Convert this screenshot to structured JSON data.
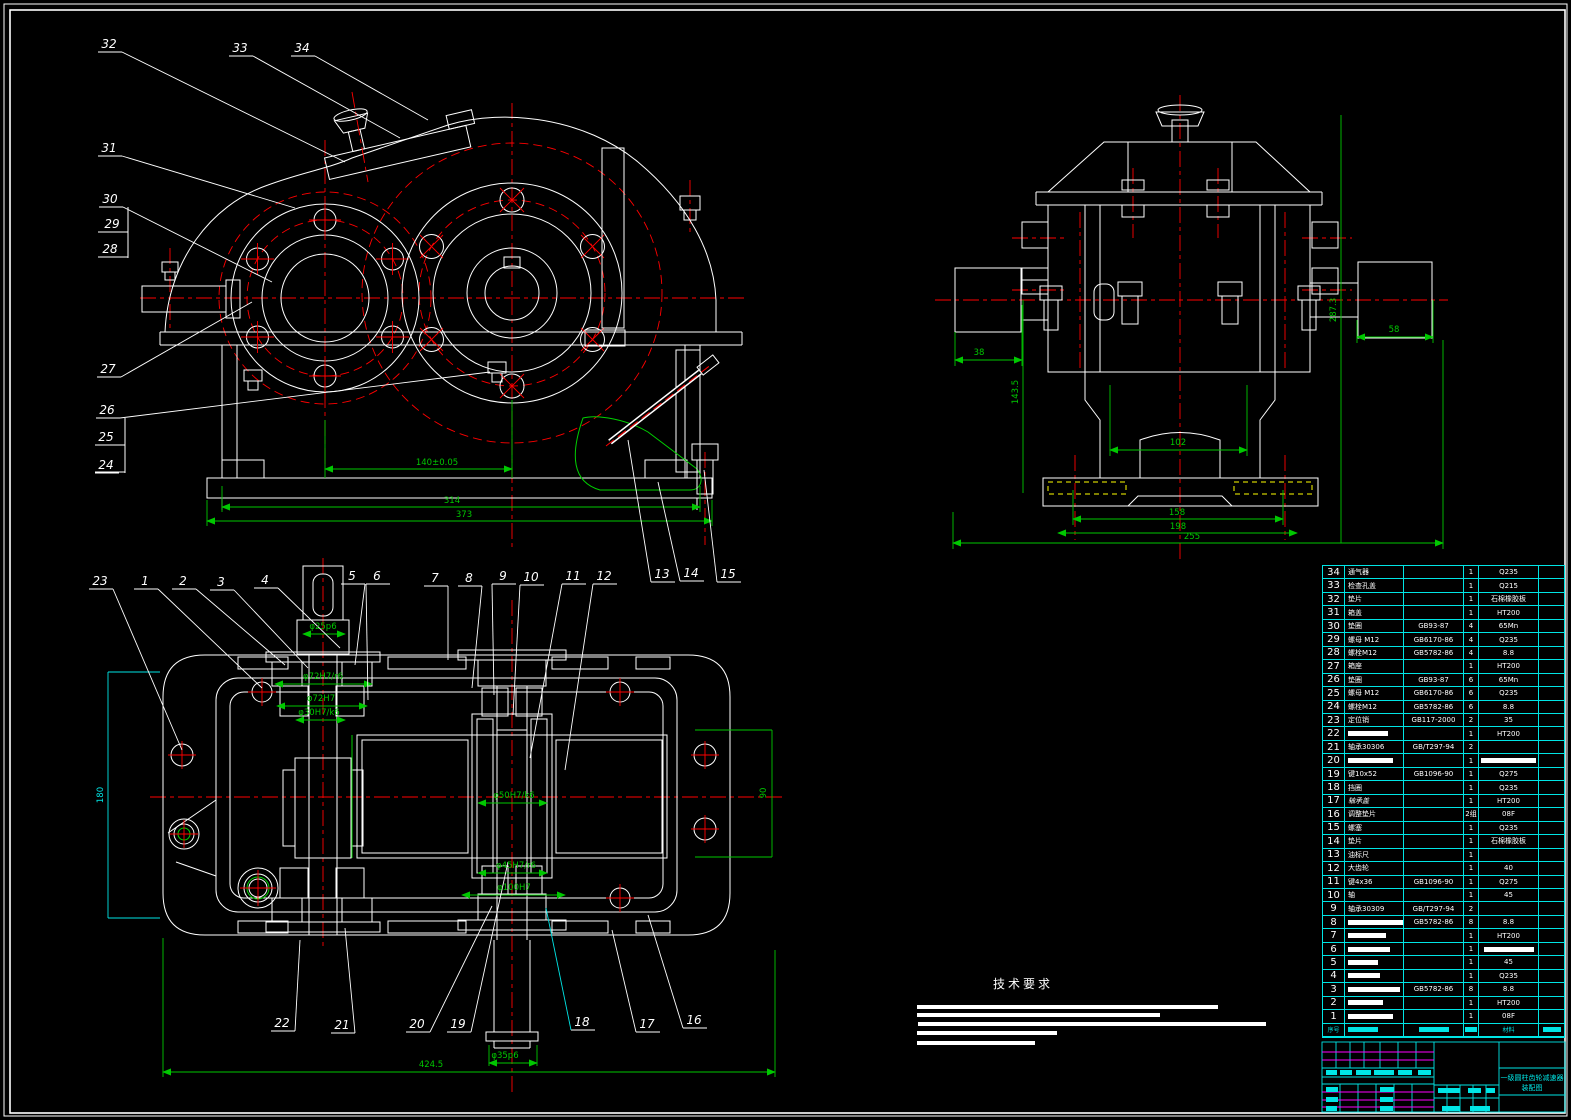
{
  "sheet": {
    "bg": "#000000",
    "line_white": "#ffffff",
    "line_red": "#ff0000",
    "line_green": "#00c800",
    "line_cyan": "#00e5e5",
    "line_yellow": "#ffff00",
    "line_magenta": "#ff00ff"
  },
  "tech_req": {
    "heading": "技术要求",
    "bars": [
      [
        917,
        1005,
        301
      ],
      [
        917,
        1013,
        243
      ],
      [
        918,
        1022,
        348
      ],
      [
        917,
        1031,
        140
      ],
      [
        917,
        1041,
        118
      ]
    ]
  },
  "title_block": {
    "title_line1": "一级圆柱齿轮减速器",
    "title_line2": "装配图",
    "bars": [
      [
        1326,
        1070,
        11
      ],
      [
        1340,
        1070,
        12
      ],
      [
        1356,
        1070,
        15
      ],
      [
        1374,
        1070,
        20
      ],
      [
        1398,
        1070,
        14
      ],
      [
        1418,
        1070,
        13
      ],
      [
        1326,
        1087,
        12
      ],
      [
        1326,
        1097,
        12
      ],
      [
        1326,
        1106,
        11
      ],
      [
        1380,
        1087,
        14
      ],
      [
        1380,
        1097,
        13
      ],
      [
        1380,
        1106,
        13
      ],
      [
        1438,
        1088,
        22
      ],
      [
        1468,
        1088,
        13
      ],
      [
        1486,
        1088,
        9
      ],
      [
        1442,
        1106,
        18
      ],
      [
        1470,
        1106,
        20
      ]
    ]
  },
  "balloons": [
    {
      "n": "32",
      "x": 107,
      "y": 48,
      "tx": 345,
      "ty": 162
    },
    {
      "n": "33",
      "x": 238,
      "y": 52,
      "tx": 400,
      "ty": 138
    },
    {
      "n": "34",
      "x": 300,
      "y": 52,
      "tx": 428,
      "ty": 120
    },
    {
      "n": "31",
      "x": 107,
      "y": 152,
      "tx": 295,
      "ty": 208
    },
    {
      "n": "30",
      "x": 108,
      "y": 203,
      "tx": 272,
      "ty": 282
    },
    {
      "n": "29",
      "x": 110,
      "y": 228
    },
    {
      "n": "28",
      "x": 108,
      "y": 253
    },
    {
      "n": "27",
      "x": 106,
      "y": 373,
      "tx": 252,
      "ty": 302
    },
    {
      "n": "26",
      "x": 105,
      "y": 414,
      "tx": 490,
      "ty": 372
    },
    {
      "n": "25",
      "x": 104,
      "y": 441
    },
    {
      "n": "24",
      "x": 104,
      "y": 469
    },
    {
      "n": "13",
      "x": 660,
      "y": 578,
      "tx": 628,
      "ty": 440
    },
    {
      "n": "14",
      "x": 689,
      "y": 577,
      "tx": 658,
      "ty": 482
    },
    {
      "n": "15",
      "x": 726,
      "y": 578,
      "tx": 704,
      "ty": 470
    },
    {
      "n": "23",
      "x": 98,
      "y": 585,
      "tx": 182,
      "ty": 750
    },
    {
      "n": "1",
      "x": 143,
      "y": 585,
      "tx": 262,
      "ty": 688
    },
    {
      "n": "2",
      "x": 181,
      "y": 585,
      "tx": 285,
      "ty": 665
    },
    {
      "n": "3",
      "x": 219,
      "y": 586,
      "tx": 308,
      "ty": 668
    },
    {
      "n": "4",
      "x": 263,
      "y": 584,
      "tx": 340,
      "ty": 648
    },
    {
      "n": "5",
      "x": 350,
      "y": 580,
      "tx": 355,
      "ty": 665
    },
    {
      "n": "6",
      "x": 375,
      "y": 580,
      "tx": 368,
      "ty": 700
    },
    {
      "n": "7",
      "x": 433,
      "y": 582,
      "tx": 448,
      "ty": 660
    },
    {
      "n": "8",
      "x": 467,
      "y": 582,
      "tx": 472,
      "ty": 688
    },
    {
      "n": "9",
      "x": 501,
      "y": 580,
      "tx": 494,
      "ty": 695
    },
    {
      "n": "10",
      "x": 529,
      "y": 581,
      "tx": 513,
      "ty": 715
    },
    {
      "n": "11",
      "x": 571,
      "y": 580,
      "tx": 530,
      "ty": 758
    },
    {
      "n": "12",
      "x": 602,
      "y": 580,
      "tx": 565,
      "ty": 770
    },
    {
      "n": "22",
      "x": 280,
      "y": 1027,
      "tx": 300,
      "ty": 940
    },
    {
      "n": "21",
      "x": 340,
      "y": 1029,
      "tx": 345,
      "ty": 928
    },
    {
      "n": "20",
      "x": 415,
      "y": 1028,
      "tx": 492,
      "ty": 906
    },
    {
      "n": "19",
      "x": 456,
      "y": 1028,
      "tx": 508,
      "ty": 862
    },
    {
      "n": "18",
      "x": 580,
      "y": 1026,
      "tx": 546,
      "ty": 908,
      "c": "#00e5e5"
    },
    {
      "n": "17",
      "x": 645,
      "y": 1028,
      "tx": 612,
      "ty": 930
    },
    {
      "n": "16",
      "x": 692,
      "y": 1024,
      "tx": 648,
      "ty": 915
    }
  ],
  "dimensions": [
    {
      "t": "140±0.05",
      "x": 437,
      "y": 465
    },
    {
      "t": "314",
      "x": 452,
      "y": 503
    },
    {
      "t": "373",
      "x": 464,
      "y": 517
    },
    {
      "t": "38",
      "x": 979,
      "y": 355
    },
    {
      "t": "143.5",
      "x": 1018,
      "y": 392,
      "rot": -90
    },
    {
      "t": "287.3",
      "x": 1336,
      "y": 310,
      "rot": -90
    },
    {
      "t": "58",
      "x": 1394,
      "y": 332
    },
    {
      "t": "102",
      "x": 1178,
      "y": 445
    },
    {
      "t": "158",
      "x": 1177,
      "y": 515
    },
    {
      "t": "198",
      "x": 1178,
      "y": 529
    },
    {
      "t": "255",
      "x": 1192,
      "y": 539
    },
    {
      "t": "φ25p6",
      "x": 323,
      "y": 629
    },
    {
      "t": "φ72H7/r6",
      "x": 323,
      "y": 679
    },
    {
      "t": "φ72H7",
      "x": 321,
      "y": 701
    },
    {
      "t": "φ30H7/k6",
      "x": 319,
      "y": 715
    },
    {
      "t": "φ50H7/k6",
      "x": 514,
      "y": 798
    },
    {
      "t": "φ45H7/r6",
      "x": 516,
      "y": 868
    },
    {
      "t": "φ100H7",
      "x": 514,
      "y": 890
    },
    {
      "t": "90",
      "x": 766,
      "y": 793,
      "rot": -90
    },
    {
      "t": "180",
      "x": 103,
      "y": 795,
      "rot": -90,
      "c": "#00e5e5"
    },
    {
      "t": "φ35p6",
      "x": 505,
      "y": 1058
    },
    {
      "t": "424.5",
      "x": 431,
      "y": 1067
    }
  ],
  "bom": {
    "header": {
      "no": "序号",
      "mat": "材料",
      "name_bar": 30,
      "std_bar": 30,
      "qty_bar": 12,
      "rk_bar": 18
    },
    "rows": [
      {
        "no": "34",
        "name": "通气器",
        "std": "",
        "qty": "1",
        "mat": "Q235",
        "rk": ""
      },
      {
        "no": "33",
        "name": "检查孔盖",
        "std": "",
        "qty": "1",
        "mat": "Q215",
        "rk": ""
      },
      {
        "no": "32",
        "name": "垫片",
        "std": "",
        "qty": "1",
        "mat": "石棉橡胶板",
        "rk": ""
      },
      {
        "no": "31",
        "name": "箱盖",
        "std": "",
        "qty": "1",
        "mat": "HT200",
        "rk": ""
      },
      {
        "no": "30",
        "name": "垫圈",
        "std": "GB93-87",
        "qty": "4",
        "mat": "65Mn",
        "rk": ""
      },
      {
        "no": "29",
        "name": "螺母 M12",
        "std": "GB6170-86",
        "qty": "4",
        "mat": "Q235",
        "rk": ""
      },
      {
        "no": "28",
        "name": "螺栓M12",
        "std": "GB5782-86",
        "qty": "4",
        "mat": "8.8",
        "rk": ""
      },
      {
        "no": "27",
        "name": "箱座",
        "std": "",
        "qty": "1",
        "mat": "HT200",
        "rk": ""
      },
      {
        "no": "26",
        "name": "垫圈",
        "std": "GB93-87",
        "qty": "6",
        "mat": "65Mn",
        "rk": ""
      },
      {
        "no": "25",
        "name": "螺母 M12",
        "std": "GB6170-86",
        "qty": "6",
        "mat": "Q235",
        "rk": ""
      },
      {
        "no": "24",
        "name": "螺栓M12",
        "std": "GB5782-86",
        "qty": "6",
        "mat": "8.8",
        "rk": ""
      },
      {
        "no": "23",
        "name": "定位销",
        "std": "GB117-2000",
        "qty": "2",
        "mat": "35",
        "rk": ""
      },
      {
        "no": "22",
        "name": "",
        "nb": 40,
        "std": "",
        "qty": "1",
        "mat": "HT200",
        "rk": ""
      },
      {
        "no": "21",
        "name": "轴承30306",
        "std": "GB/T297-94",
        "qty": "2",
        "mat": "",
        "rk": ""
      },
      {
        "no": "20",
        "name": "",
        "nb": 45,
        "std": "",
        "qty": "1",
        "mat": "",
        "mb": 55,
        "rk": ""
      },
      {
        "no": "19",
        "name": "键10x52",
        "std": "GB1096-90",
        "qty": "1",
        "mat": "Q275",
        "rk": ""
      },
      {
        "no": "18",
        "name": "挡圈",
        "std": "",
        "qty": "1",
        "mat": "Q235",
        "rk": ""
      },
      {
        "no": "17",
        "name": "轴承盖",
        "italic": true,
        "std": "",
        "qty": "1",
        "mat": "HT200",
        "rk": ""
      },
      {
        "no": "16",
        "name": "调整垫片",
        "std": "",
        "qty": "2组",
        "mat": "08F",
        "rk": ""
      },
      {
        "no": "15",
        "name": "螺塞",
        "std": "",
        "qty": "1",
        "mat": "Q235",
        "rk": ""
      },
      {
        "no": "14",
        "name": "垫片",
        "std": "",
        "qty": "1",
        "mat": "石棉橡胶板",
        "rk": ""
      },
      {
        "no": "13",
        "name": "油标尺",
        "std": "",
        "qty": "1",
        "mat": "",
        "rk": ""
      },
      {
        "no": "12",
        "name": "大齿轮",
        "std": "",
        "qty": "1",
        "mat": "40",
        "rk": ""
      },
      {
        "no": "11",
        "name": "键4x36",
        "std": "GB1096-90",
        "qty": "1",
        "mat": "Q275",
        "rk": ""
      },
      {
        "no": "10",
        "name": "轴",
        "std": "",
        "qty": "1",
        "mat": "45",
        "rk": ""
      },
      {
        "no": "9",
        "name": "轴承30309",
        "std": "GB/T297-94",
        "qty": "2",
        "mat": "",
        "rk": ""
      },
      {
        "no": "8",
        "name": "",
        "nb": 55,
        "std": "GB5782-86",
        "qty": "8",
        "mat": "8.8",
        "rk": ""
      },
      {
        "no": "7",
        "name": "",
        "nb": 38,
        "std": "",
        "qty": "1",
        "mat": "HT200",
        "rk": ""
      },
      {
        "no": "6",
        "name": "",
        "nb": 42,
        "std": "",
        "qty": "1",
        "mat": "",
        "mb": 50,
        "rk": ""
      },
      {
        "no": "5",
        "name": "",
        "nb": 30,
        "std": "",
        "qty": "1",
        "mat": "45",
        "rk": ""
      },
      {
        "no": "4",
        "name": "",
        "nb": 32,
        "std": "",
        "qty": "1",
        "mat": "Q235",
        "rk": ""
      },
      {
        "no": "3",
        "name": "",
        "nb": 52,
        "std": "GB5782-86",
        "qty": "8",
        "mat": "8.8",
        "rk": ""
      },
      {
        "no": "2",
        "name": "",
        "nb": 35,
        "std": "",
        "qty": "1",
        "mat": "HT200",
        "rk": ""
      },
      {
        "no": "1",
        "name": "",
        "nb": 45,
        "std": "",
        "qty": "1",
        "mat": "08F",
        "rk": ""
      }
    ]
  }
}
